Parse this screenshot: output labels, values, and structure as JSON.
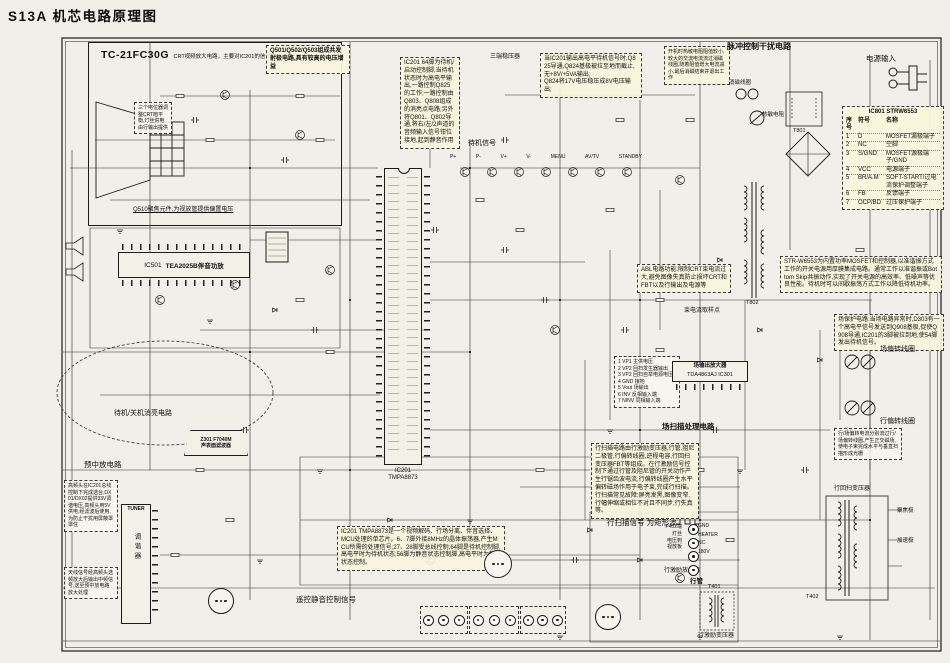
{
  "page": {
    "title": "S13A 机芯电路原理图"
  },
  "crt": {
    "model": "TC-21FC30G",
    "desc": "CRT视频放大电路，主要对IC201的信号进行视频放大。",
    "footnote": "Q510聚焦元件,为视放管提供偏置电压",
    "note": "三个电位器调整CRT暗平衡,灯丝供电由行输出提供"
  },
  "annotations": [
    {
      "text": "Q501/Q502/Q503组成共发射极电路,具有较高的电压增益"
    },
    {
      "text": "IC201 64脚为待机/启动控制脚,当待机状态时为高电平输出,一路控制Q825的工作;一路控制由Q803、Q808组成的消亮点电路;另外将Q801、Q802导通,将右/左/2声道的音频输入信号钳位接地,起到静音作用"
    },
    {
      "text": "当IC201输出高电平待机信号时,Q825导通,Q824基极被拉至地而截止,无+8V/+5VA输出;\nQ824将17V电压稳压成8V电压输出;"
    },
    {
      "text": "开机时热敏电阻阻值较小,较大的交流电流流过消磁线圈,随着阻值增大电流减小,最后消磁结束并退出工作"
    },
    {
      "text": "STR-W6553为内置功率MOSFET和控制器,以准谐振方式工作的开关电源用厚膜集成电路。通常工作以准谐振或Bottom Skip共振动作,实现了开关电源的高效率、低噪声等优良性能。待机时可以间歇振荡方式工作以降低待机功率。"
    },
    {
      "text": "ABL电路功能:限制CRT束电流过大,避免图像失真防止损坏CRT和FBT以及行输出及电源等"
    },
    {
      "text": "场保护电路:当场电路异常时,D303有一个高电平信号发送到Q908基极,促使Q908导通,IC201的3脚被拉到地,使54脚发出待机信号。"
    },
    {
      "text": "1 VP1 主供电压\n2 VP2 回扫发生器输出\n3 VP2 回扫自举电源电压\n4 GND 接地\n5 Vout 场输出\n6 INV 反相输入端\n7 NINV 同相输入端"
    },
    {
      "text": "行扫描电路由行激励变压器,行管,阻尼二极管,行偏转线圈,逆程电容,行回扫变压器FBT等组成。在行激励信号控制下通过行管及阻尼管的开关动作产生行锯齿波电流,行偏转线圈产生水平偏转磁场作用于电子束,完成行扫描。\n行扫描常见故障:屏亮发黑,图像变窄,行幅伸缩或相位不对且不同步,行失真等。"
    },
    {
      "text": "IC201 TMPA8873是一个视频解码、行场分离、伴音选择、MCU处理的单芯片。6、7脚外接8MHz的晶体振荡器,产生MCU所需的处理信号;27、28脚受总线控制;64脚是待机控制脚,高电平时为待机状态;56脚为静音状态控制脚,高电平时为静音状态控制。"
    },
    {
      "text": "高频头在IC201总线控制下完成选台,DX01/DX02提供33V调谐电压,高频头用5V供电,经滤波后使用,为防止干扰用屏蔽罩罩住"
    },
    {
      "text": "天线信号经高频头选频放大后输出中频信号,送至预中放电路放大处理"
    },
    {
      "text": "行/场偏转电流分别流过行/场偏转线圈,产生正交磁场,使电子束完成水平与垂直扫描形成光栅"
    }
  ],
  "labels": [
    {
      "text": "脉冲控制干扰电路"
    },
    {
      "text": "电源输入"
    },
    {
      "text": "消磁线圈"
    },
    {
      "text": "热敏电阻"
    },
    {
      "text": "三端稳压器"
    },
    {
      "text": "待机信号"
    },
    {
      "text": "待机/关机消亮电路"
    },
    {
      "text": "预中放电路"
    },
    {
      "text": "场扫描处理电路"
    },
    {
      "text": "场偏转线圈"
    },
    {
      "text": "行偏转线圈"
    },
    {
      "text": "行扫描信号 为矩形波"
    },
    {
      "text": "行回扫变压器"
    },
    {
      "text": "行激励变压器"
    },
    {
      "text": "行激励放大器"
    },
    {
      "text": "行管"
    },
    {
      "text": "束电流取样点"
    },
    {
      "text": "遥控静音控制信号"
    },
    {
      "text": "聚焦极"
    },
    {
      "text": "加速极"
    }
  ],
  "ics": {
    "ic201": {
      "ref": "IC201",
      "part": "TMPA8873"
    },
    "ic501": {
      "ref": "IC501",
      "part": "TEA2025B伴音功放"
    },
    "ic301": {
      "line1": "场输出放大器",
      "line2": "TDA4863AJ IC301"
    },
    "saw": {
      "line1": "Z301 F7040M",
      "line2": "声表面滤波器"
    },
    "tuner": {
      "en": "TUNER",
      "cn": "调谐器"
    }
  },
  "refs": {
    "t801": "T801",
    "t802": "T802",
    "t401": "T401",
    "t402": "T402"
  },
  "p402": {
    "lines": "P402端\n灯丝\n电压到\n视放板",
    "pins": [
      "GND",
      "HEATER",
      "NC",
      "180V"
    ]
  },
  "keys": {
    "items": [
      "P+",
      "P-",
      "V+",
      "V-",
      "MENU",
      "AV/TV",
      "STANDBY"
    ]
  },
  "ic801_table": {
    "title": "IC801 STRW6553",
    "headers": [
      "序号",
      "符号",
      "名称"
    ],
    "rows": [
      [
        "1",
        "D",
        "MOSFET漏极端子"
      ],
      [
        "2",
        "NC",
        "空脚"
      ],
      [
        "3",
        "S/GND",
        "MOSFET源极端子/GND"
      ],
      [
        "4",
        "VCC",
        "电源端子"
      ],
      [
        "5",
        "BR/A.M",
        "SOFT-START/过电流保护调整端子"
      ],
      [
        "6",
        "FB",
        "反馈端子"
      ],
      [
        "7",
        "OCP/BD",
        "过压保护端子"
      ]
    ]
  }
}
